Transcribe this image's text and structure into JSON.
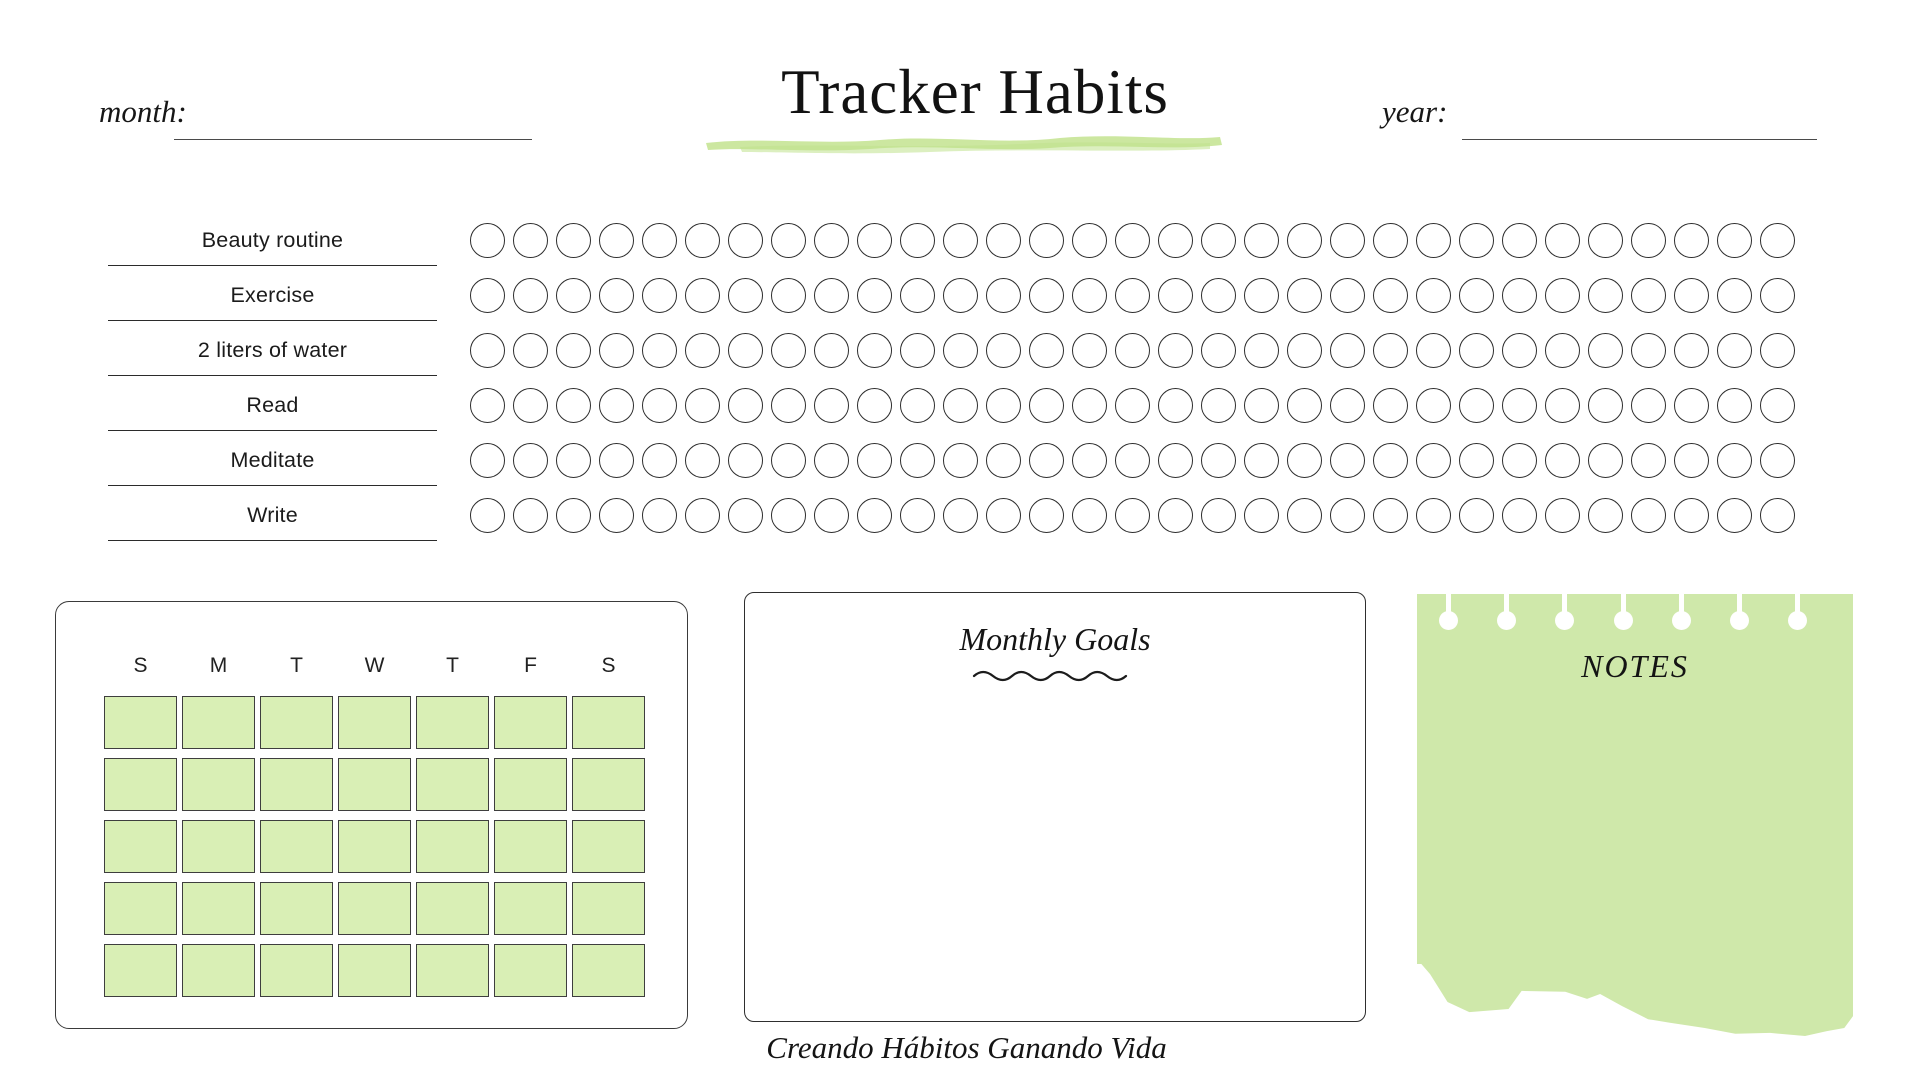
{
  "header": {
    "title": "Tracker Habits",
    "month_label": "month:",
    "month_value": "",
    "year_label": "year:",
    "year_value": ""
  },
  "tracker": {
    "habits": [
      {
        "label": "Beauty routine"
      },
      {
        "label": "Exercise"
      },
      {
        "label": "2 liters of water"
      },
      {
        "label": "Read"
      },
      {
        "label": "Meditate"
      },
      {
        "label": "Write"
      }
    ],
    "days_per_row": 31
  },
  "calendar": {
    "day_headers": [
      "S",
      "M",
      "T",
      "W",
      "T",
      "F",
      "S"
    ],
    "week_rows": 5,
    "days_per_week": 7
  },
  "goals": {
    "title": "Monthly Goals"
  },
  "notes": {
    "title": "NOTES",
    "hole_count": 7
  },
  "footer": {
    "quote": "Creando Hábitos Ganando Vida"
  },
  "colors": {
    "highlight_green": "#c9e69b",
    "calendar_cell_green": "#d9efb5",
    "notes_green": "#cfe8aa",
    "ink": "#1e1e1e"
  }
}
